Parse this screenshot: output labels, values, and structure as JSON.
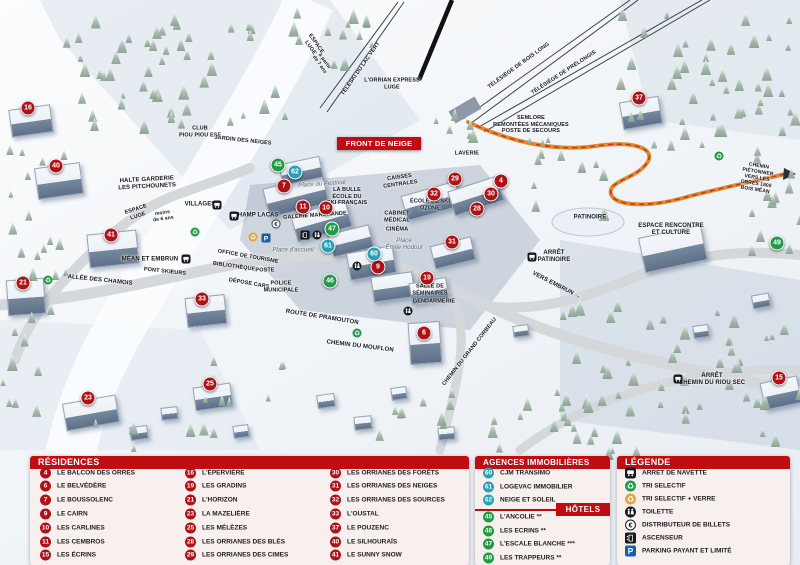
{
  "map": {
    "banner": "FRONT DE NEIGE 1650",
    "markers": [
      {
        "n": 4,
        "x": 501,
        "y": 181,
        "k": "r"
      },
      {
        "n": 6,
        "x": 424,
        "y": 333,
        "k": "r"
      },
      {
        "n": 7,
        "x": 284,
        "y": 186,
        "k": "r"
      },
      {
        "n": 9,
        "x": 378,
        "y": 267,
        "k": "r"
      },
      {
        "n": 10,
        "x": 326,
        "y": 208,
        "k": "r"
      },
      {
        "n": 11,
        "x": 303,
        "y": 207,
        "k": "r"
      },
      {
        "n": 15,
        "x": 779,
        "y": 378,
        "k": "r"
      },
      {
        "n": 16,
        "x": 28,
        "y": 108,
        "k": "r"
      },
      {
        "n": 19,
        "x": 427,
        "y": 278,
        "k": "r"
      },
      {
        "n": 21,
        "x": 23,
        "y": 283,
        "k": "r"
      },
      {
        "n": 23,
        "x": 88,
        "y": 398,
        "k": "r"
      },
      {
        "n": 25,
        "x": 210,
        "y": 384,
        "k": "r"
      },
      {
        "n": 28,
        "x": 477,
        "y": 209,
        "k": "r"
      },
      {
        "n": 29,
        "x": 455,
        "y": 179,
        "k": "r"
      },
      {
        "n": 30,
        "x": 491,
        "y": 194,
        "k": "r"
      },
      {
        "n": 31,
        "x": 452,
        "y": 242,
        "k": "r"
      },
      {
        "n": 32,
        "x": 434,
        "y": 194,
        "k": "r"
      },
      {
        "n": 33,
        "x": 202,
        "y": 299,
        "k": "r"
      },
      {
        "n": 37,
        "x": 639,
        "y": 98,
        "k": "r"
      },
      {
        "n": 40,
        "x": 56,
        "y": 166,
        "k": "r"
      },
      {
        "n": 41,
        "x": 111,
        "y": 235,
        "k": "r"
      },
      {
        "n": 45,
        "x": 278,
        "y": 165,
        "k": "h"
      },
      {
        "n": 46,
        "x": 330,
        "y": 281,
        "k": "h"
      },
      {
        "n": 47,
        "x": 332,
        "y": 229,
        "k": "h"
      },
      {
        "n": 49,
        "x": 777,
        "y": 243,
        "k": "h"
      },
      {
        "n": 60,
        "x": 374,
        "y": 254,
        "k": "a"
      },
      {
        "n": 61,
        "x": 328,
        "y": 246,
        "k": "a"
      },
      {
        "n": 62,
        "x": 295,
        "y": 172,
        "k": "a"
      }
    ],
    "labels": [
      {
        "t": "ESPACE\nLUGE",
        "x": 313,
        "y": 46,
        "r": 55,
        "s": "sm"
      },
      {
        "t": "à partir\nde 7 ans",
        "x": 322,
        "y": 63,
        "r": 55,
        "s": "tiny"
      },
      {
        "t": "TÉLÉSKI DU LAC VERT",
        "x": 361,
        "y": 69,
        "r": -55,
        "s": "sm"
      },
      {
        "t": "L'ORRIAN EXPRESS\nLUGE",
        "x": 392,
        "y": 84,
        "r": 0,
        "s": "sm"
      },
      {
        "t": "TÉLÉSIÈGE DE BOIS LONG",
        "x": 519,
        "y": 66,
        "r": -36,
        "s": "sm"
      },
      {
        "t": "TÉLÉSIÈGE DE PRÉLONGIS",
        "x": 564,
        "y": 73,
        "r": -33,
        "s": "sm"
      },
      {
        "t": "SEMLORE\nREMONTÉES MÉCANIQUES\nPOSTE DE SECOURS",
        "x": 531,
        "y": 125,
        "r": 0,
        "s": "sm"
      },
      {
        "t": "CLUB\nPIOU PIOU ESF",
        "x": 200,
        "y": 132,
        "r": 0,
        "s": "sm"
      },
      {
        "t": "JARDIN DES NEIGES",
        "x": 243,
        "y": 141,
        "r": 6,
        "s": "sm"
      },
      {
        "t": "HALTE GARDERIE\nLES PITCHOUNETS",
        "x": 147,
        "y": 184,
        "r": -3,
        "s": "b"
      },
      {
        "t": "ESPACE\nLUGE",
        "x": 137,
        "y": 213,
        "r": -18,
        "s": "sm"
      },
      {
        "t": "moins\nde 6 ans",
        "x": 163,
        "y": 216,
        "r": -8,
        "s": "tiny"
      },
      {
        "t": "VILLAGES",
        "x": 200,
        "y": 205,
        "r": 0,
        "s": "b"
      },
      {
        "t": "CHAMP LACAS",
        "x": 256,
        "y": 216,
        "r": 0,
        "s": "b"
      },
      {
        "t": "MÉAN ET EMBRUN",
        "x": 150,
        "y": 260,
        "r": 0,
        "s": "b"
      },
      {
        "t": "PONT SKIEURS",
        "x": 165,
        "y": 272,
        "r": 6,
        "s": "sm"
      },
      {
        "t": "ALLÉE DES CHAMOIS",
        "x": 100,
        "y": 281,
        "r": 6,
        "s": "b"
      },
      {
        "t": "Place du Festival",
        "x": 322,
        "y": 185,
        "r": -4,
        "s": "i"
      },
      {
        "t": "LA BULLE\nÉCOLE DU\nSKI FRANÇAIS",
        "x": 347,
        "y": 197,
        "r": 0,
        "s": "sm"
      },
      {
        "t": "GALERIE MARCHANDE",
        "x": 315,
        "y": 216,
        "r": -4,
        "s": "sm"
      },
      {
        "t": "CAISSES\nCENTRALES",
        "x": 400,
        "y": 181,
        "r": -8,
        "s": "sm"
      },
      {
        "t": "LAVERIE",
        "x": 467,
        "y": 154,
        "r": 0,
        "s": "sm"
      },
      {
        "t": "ÉCOLE DE SKI\nOZONE",
        "x": 430,
        "y": 205,
        "r": 0,
        "s": "sm"
      },
      {
        "t": "CABINET\nMÉDICAL",
        "x": 397,
        "y": 217,
        "r": 0,
        "s": "sm"
      },
      {
        "t": "CINÉMA",
        "x": 397,
        "y": 230,
        "r": 0,
        "s": "sm"
      },
      {
        "t": "Place\nÉmile Hodoul",
        "x": 404,
        "y": 245,
        "r": 0,
        "s": "i"
      },
      {
        "t": "OFFICE DE TOURISME",
        "x": 248,
        "y": 257,
        "r": 10,
        "s": "sm"
      },
      {
        "t": "BIBLIOTHÈQUE",
        "x": 234,
        "y": 267,
        "r": 8,
        "s": "sm"
      },
      {
        "t": "POSTE",
        "x": 265,
        "y": 271,
        "r": 0,
        "s": "sm"
      },
      {
        "t": "DÉPOSE CARS",
        "x": 249,
        "y": 284,
        "r": 10,
        "s": "sm"
      },
      {
        "t": "POLICE\nMUNICIPALE",
        "x": 281,
        "y": 287,
        "r": 0,
        "s": "sm"
      },
      {
        "t": "Place d'accueil",
        "x": 293,
        "y": 251,
        "r": 0,
        "s": "i"
      },
      {
        "t": "SALLE DE\nSÉMINAIRES",
        "x": 430,
        "y": 290,
        "r": 0,
        "s": "sm"
      },
      {
        "t": "GENDARMERIE",
        "x": 434,
        "y": 302,
        "r": 0,
        "s": "sm"
      },
      {
        "t": "ROUTE DE PRAMOUTON",
        "x": 322,
        "y": 318,
        "r": 9,
        "s": "b"
      },
      {
        "t": "CHEMIN DU MOUFLON",
        "x": 360,
        "y": 347,
        "r": 7,
        "s": "b"
      },
      {
        "t": "CHEMIN DU GRAND CORBEAU",
        "x": 470,
        "y": 352,
        "r": -52,
        "s": "sm"
      },
      {
        "t": "ARRÊT\nPATINOIRE",
        "x": 554,
        "y": 257,
        "r": 0,
        "s": "b"
      },
      {
        "t": "VERS EMBRUN →",
        "x": 556,
        "y": 286,
        "r": 27,
        "s": "b"
      },
      {
        "t": "CHEMIN PIÉTONNIER\nVERS LES ORRES 1800\nBOIS MÉAN",
        "x": 757,
        "y": 178,
        "r": 9,
        "s": "tiny"
      },
      {
        "t": "ESPACE RENCONTRE\nET CULTURE",
        "x": 671,
        "y": 230,
        "r": 0,
        "s": "b"
      },
      {
        "t": "PATINOIRE",
        "x": 590,
        "y": 218,
        "r": 0,
        "s": "b"
      },
      {
        "t": "ARRÊT\nCHEMIN DU RIOU SEC",
        "x": 712,
        "y": 380,
        "r": 0,
        "s": "b"
      }
    ],
    "icons": [
      {
        "type": "bus",
        "x": 217,
        "y": 205
      },
      {
        "type": "bus",
        "x": 234,
        "y": 216
      },
      {
        "type": "bus",
        "x": 186,
        "y": 259
      },
      {
        "type": "bus",
        "x": 532,
        "y": 257
      },
      {
        "type": "bus",
        "x": 678,
        "y": 379
      },
      {
        "type": "recycle",
        "x": 195,
        "y": 232
      },
      {
        "type": "recycle",
        "x": 48,
        "y": 280
      },
      {
        "type": "recycle",
        "x": 357,
        "y": 333
      },
      {
        "type": "recycle",
        "x": 719,
        "y": 156
      },
      {
        "type": "recycle-verre",
        "x": 253,
        "y": 237
      },
      {
        "type": "parking",
        "x": 266,
        "y": 238
      },
      {
        "type": "euro",
        "x": 276,
        "y": 224
      },
      {
        "type": "wc",
        "x": 317,
        "y": 235
      },
      {
        "type": "wc",
        "x": 357,
        "y": 266
      },
      {
        "type": "wc",
        "x": 408,
        "y": 311
      },
      {
        "type": "elevator",
        "x": 305,
        "y": 235
      }
    ]
  },
  "panels": {
    "residences": {
      "title": "RÉSIDENCES",
      "items": [
        {
          "n": 4,
          "label": "LE BALCON DES ORRES"
        },
        {
          "n": 6,
          "label": "LE BELVÉDÈRE"
        },
        {
          "n": 7,
          "label": "LE BOUSSOLENC"
        },
        {
          "n": 9,
          "label": "LE CAIRN"
        },
        {
          "n": 10,
          "label": "LES CARLINES"
        },
        {
          "n": 11,
          "label": "LES CEMBROS"
        },
        {
          "n": 15,
          "label": "LES ÉCRINS"
        },
        {
          "n": 16,
          "label": "L'ÉPERVIÈRE"
        },
        {
          "n": 19,
          "label": "LES GRADINS"
        },
        {
          "n": 21,
          "label": "L'HORIZON"
        },
        {
          "n": 23,
          "label": "LA MAZELIÈRE"
        },
        {
          "n": 25,
          "label": "LES MÉLÈZES"
        },
        {
          "n": 28,
          "label": "LES ORRIANES DES BLÉS"
        },
        {
          "n": 29,
          "label": "LES ORRIANES DES CIMES"
        },
        {
          "n": 30,
          "label": "LES ORRIANES DES FORÊTS"
        },
        {
          "n": 31,
          "label": "LES ORRIANES DES NEIGES"
        },
        {
          "n": 32,
          "label": "LES ORRIANES DES SOURCES"
        },
        {
          "n": 33,
          "label": "L'OUSTAL"
        },
        {
          "n": 37,
          "label": "LE POUZENC"
        },
        {
          "n": 40,
          "label": "LE SILHOURAÏS"
        },
        {
          "n": 41,
          "label": "LE SUNNY SNOW"
        }
      ]
    },
    "agences": {
      "title": "AGENCES IMMOBILIÈRES",
      "items": [
        {
          "n": 60,
          "label": "CJM TRANSIMO"
        },
        {
          "n": 61,
          "label": "LOGEVAC IMMOBILIER"
        },
        {
          "n": 62,
          "label": "NEIGE ET SOLEIL"
        }
      ]
    },
    "hotels": {
      "title": "HÔTELS",
      "items": [
        {
          "n": 45,
          "label": "L'ANCOLIE **"
        },
        {
          "n": 46,
          "label": "LES ECRINS **"
        },
        {
          "n": 47,
          "label": "L'ESCALE BLANCHE ***"
        },
        {
          "n": 49,
          "label": "LES TRAPPEURS **"
        }
      ]
    },
    "legende": {
      "title": "LÉGENDE",
      "items": [
        {
          "icon": "bus",
          "label": "ARRET DE NAVETTE"
        },
        {
          "icon": "recycle",
          "label": "TRI SELECTIF"
        },
        {
          "icon": "recycle-verre",
          "label": "TRI SELECTIF + VERRE"
        },
        {
          "icon": "wc",
          "label": "TOILETTE"
        },
        {
          "icon": "euro",
          "label": "DISTRIBUTEUR DE BILLETS"
        },
        {
          "icon": "elevator",
          "label": "ASCENSEUR"
        },
        {
          "icon": "parking",
          "label": "PARKING PAYANT ET LIMITÉ"
        }
      ]
    }
  },
  "colors": {
    "residence": "#b01116",
    "hotel": "#1f9b44",
    "agence": "#2aa0b4",
    "header": "#c00d12",
    "parking": "#1660a8",
    "verre": "#e8a13c",
    "path_orange": "#e08a2e",
    "path_red_dash": "#c3331f"
  }
}
